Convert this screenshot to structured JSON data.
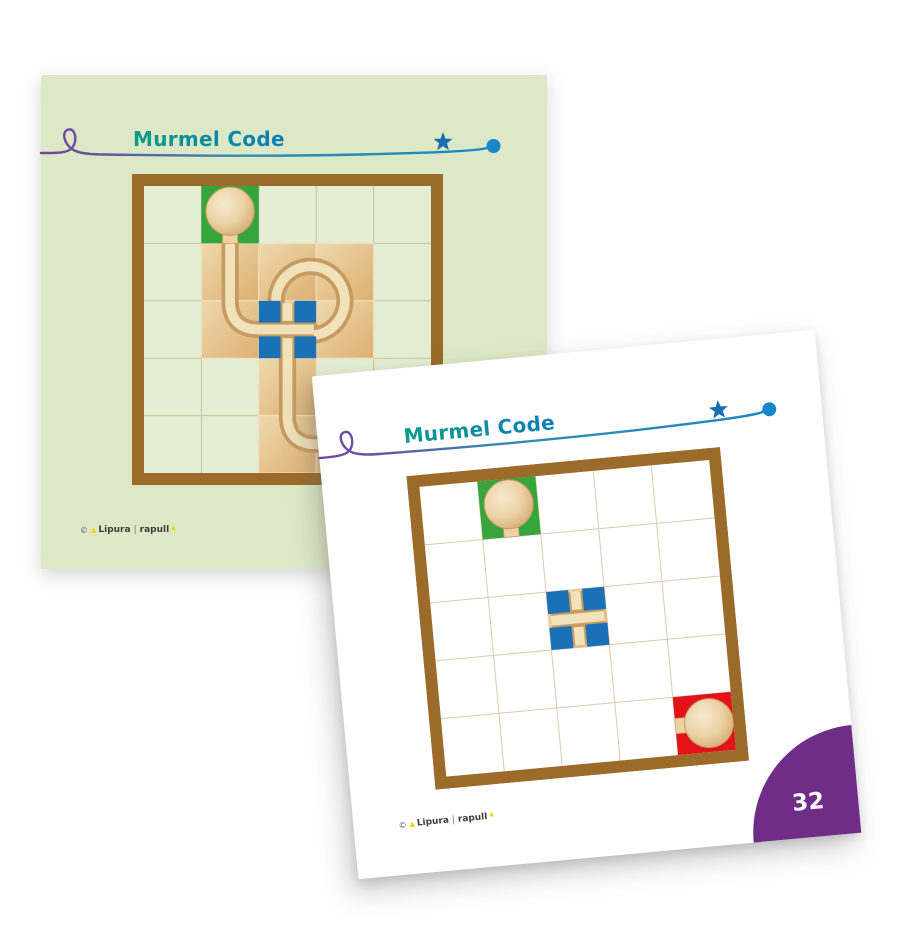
{
  "cards": {
    "back": {
      "title": "Murmel Code",
      "board": {
        "size": 311,
        "cell_background": "#e4eed3",
        "gridline": "#cfbf96",
        "wood_cells": [
          [
            1,
            1
          ],
          [
            1,
            2
          ],
          [
            1,
            3
          ],
          [
            2,
            1
          ],
          [
            2,
            2
          ],
          [
            2,
            3
          ],
          [
            3,
            2
          ],
          [
            4,
            2
          ],
          [
            4,
            3
          ]
        ],
        "cross_cells": [
          [
            2,
            2
          ]
        ],
        "start_cell": {
          "row": 0,
          "col": 1,
          "stem": "down"
        },
        "end_cell": null,
        "tracks": [
          {
            "type": "route",
            "pts": [
              [
                1.5,
                1.0
              ],
              [
                1.5,
                2.5
              ],
              [
                2.9,
                2.5
              ]
            ],
            "radius": 0.5
          },
          {
            "type": "ring",
            "cx": 2.9,
            "cy": 2.0,
            "r": 0.6
          },
          {
            "type": "route",
            "pts": [
              [
                2.5,
                2.5
              ],
              [
                2.5,
                4.5
              ],
              [
                3.98,
                4.5
              ]
            ],
            "radius": 0.5
          }
        ]
      }
    },
    "front": {
      "title": "Murmel Code",
      "page_number": "32",
      "board": {
        "size": 315,
        "cell_background": "#ffffff",
        "gridline": "#dccaab",
        "wood_cells": [],
        "cross_cells": [
          [
            2,
            2
          ]
        ],
        "start_cell": {
          "row": 0,
          "col": 1,
          "stem": "down"
        },
        "end_cell": {
          "row": 4,
          "col": 4,
          "stem": "left"
        },
        "tracks": []
      }
    }
  },
  "brand": {
    "copyright": "©",
    "name1": "Lipura",
    "separator": "|",
    "name2": "rapull"
  },
  "colors": {
    "page_bg": "#ffffff",
    "card_back_bg": "#dde9c6",
    "card_front_bg": "#ffffff",
    "frame_brown": "#9c6a29",
    "wood_light": "#efd9ae",
    "wood_dark": "#ddb071",
    "wood_seam": "#f3e5c5",
    "groove_dark": "#c79c62",
    "groove_light": "#f2e2ba",
    "marble_light": "#f7ead0",
    "marble_mid": "#ecd2a4",
    "marble_dark": "#d2a76e",
    "marble_rim": "#c89e63",
    "start_green": "#35a53c",
    "end_red": "#e41318",
    "peg_blue": "#1b71b8",
    "title_teal": "#0a9a8c",
    "title_blue": "#0e7cba",
    "squiggle_purple": "#7a3fa0",
    "line_teal": "#2e8fae",
    "line_blue": "#1b86c5",
    "star_blue": "#1c6cb0",
    "dot_blue": "#1787c9",
    "corner_purple": "#6f2d88",
    "page_number_color": "#ffffff",
    "brand_text": "#3b3b3b",
    "brand_yellow": "#f0d400"
  }
}
